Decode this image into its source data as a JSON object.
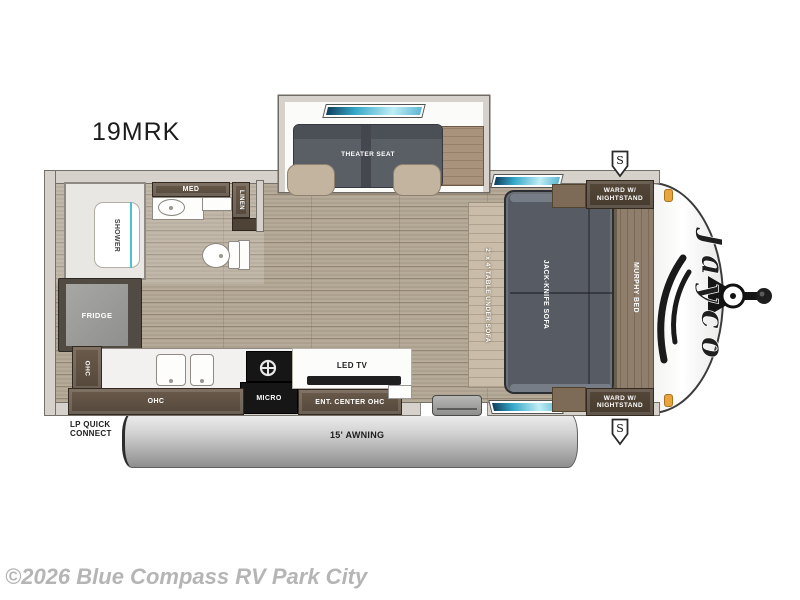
{
  "title": "19MRK",
  "watermark": "©2026 Blue Compass RV Park City",
  "logo_text": "Jayco",
  "rooms": {
    "theater_seat": "THEATER SEAT",
    "shower": "SHOWER",
    "med": "MED",
    "linen": "LINEN",
    "fridge": "FRIDGE",
    "ohc_side": "OHC",
    "ohc_bottom": "OHC",
    "micro": "MICRO",
    "ent_center": "ENT. CENTER OHC",
    "led_tv": "LED TV",
    "table": "2' x 4' TABLE UNDER SOFA",
    "sofa": "JACK-KNIFE SOFA",
    "murphy_bed": "MURPHY BED",
    "ward_line1": "WARD W/",
    "ward_line2": "NIGHTSTAND",
    "awning": "15' AWNING",
    "lp_line1": "LP QUICK",
    "lp_line2": "CONNECT",
    "speaker_symbol": "S"
  },
  "colors": {
    "wall": "#d6d2cb",
    "wood_floor": "#b2a694",
    "cabinet_dark": "#5a4c3f",
    "sofa_gray": "#575c64",
    "murphy_brown": "#8e7e6b",
    "window_teal": "#35a8c8",
    "marker_orange": "#e9a43d",
    "watermark_gray": "#b5b5b5"
  }
}
